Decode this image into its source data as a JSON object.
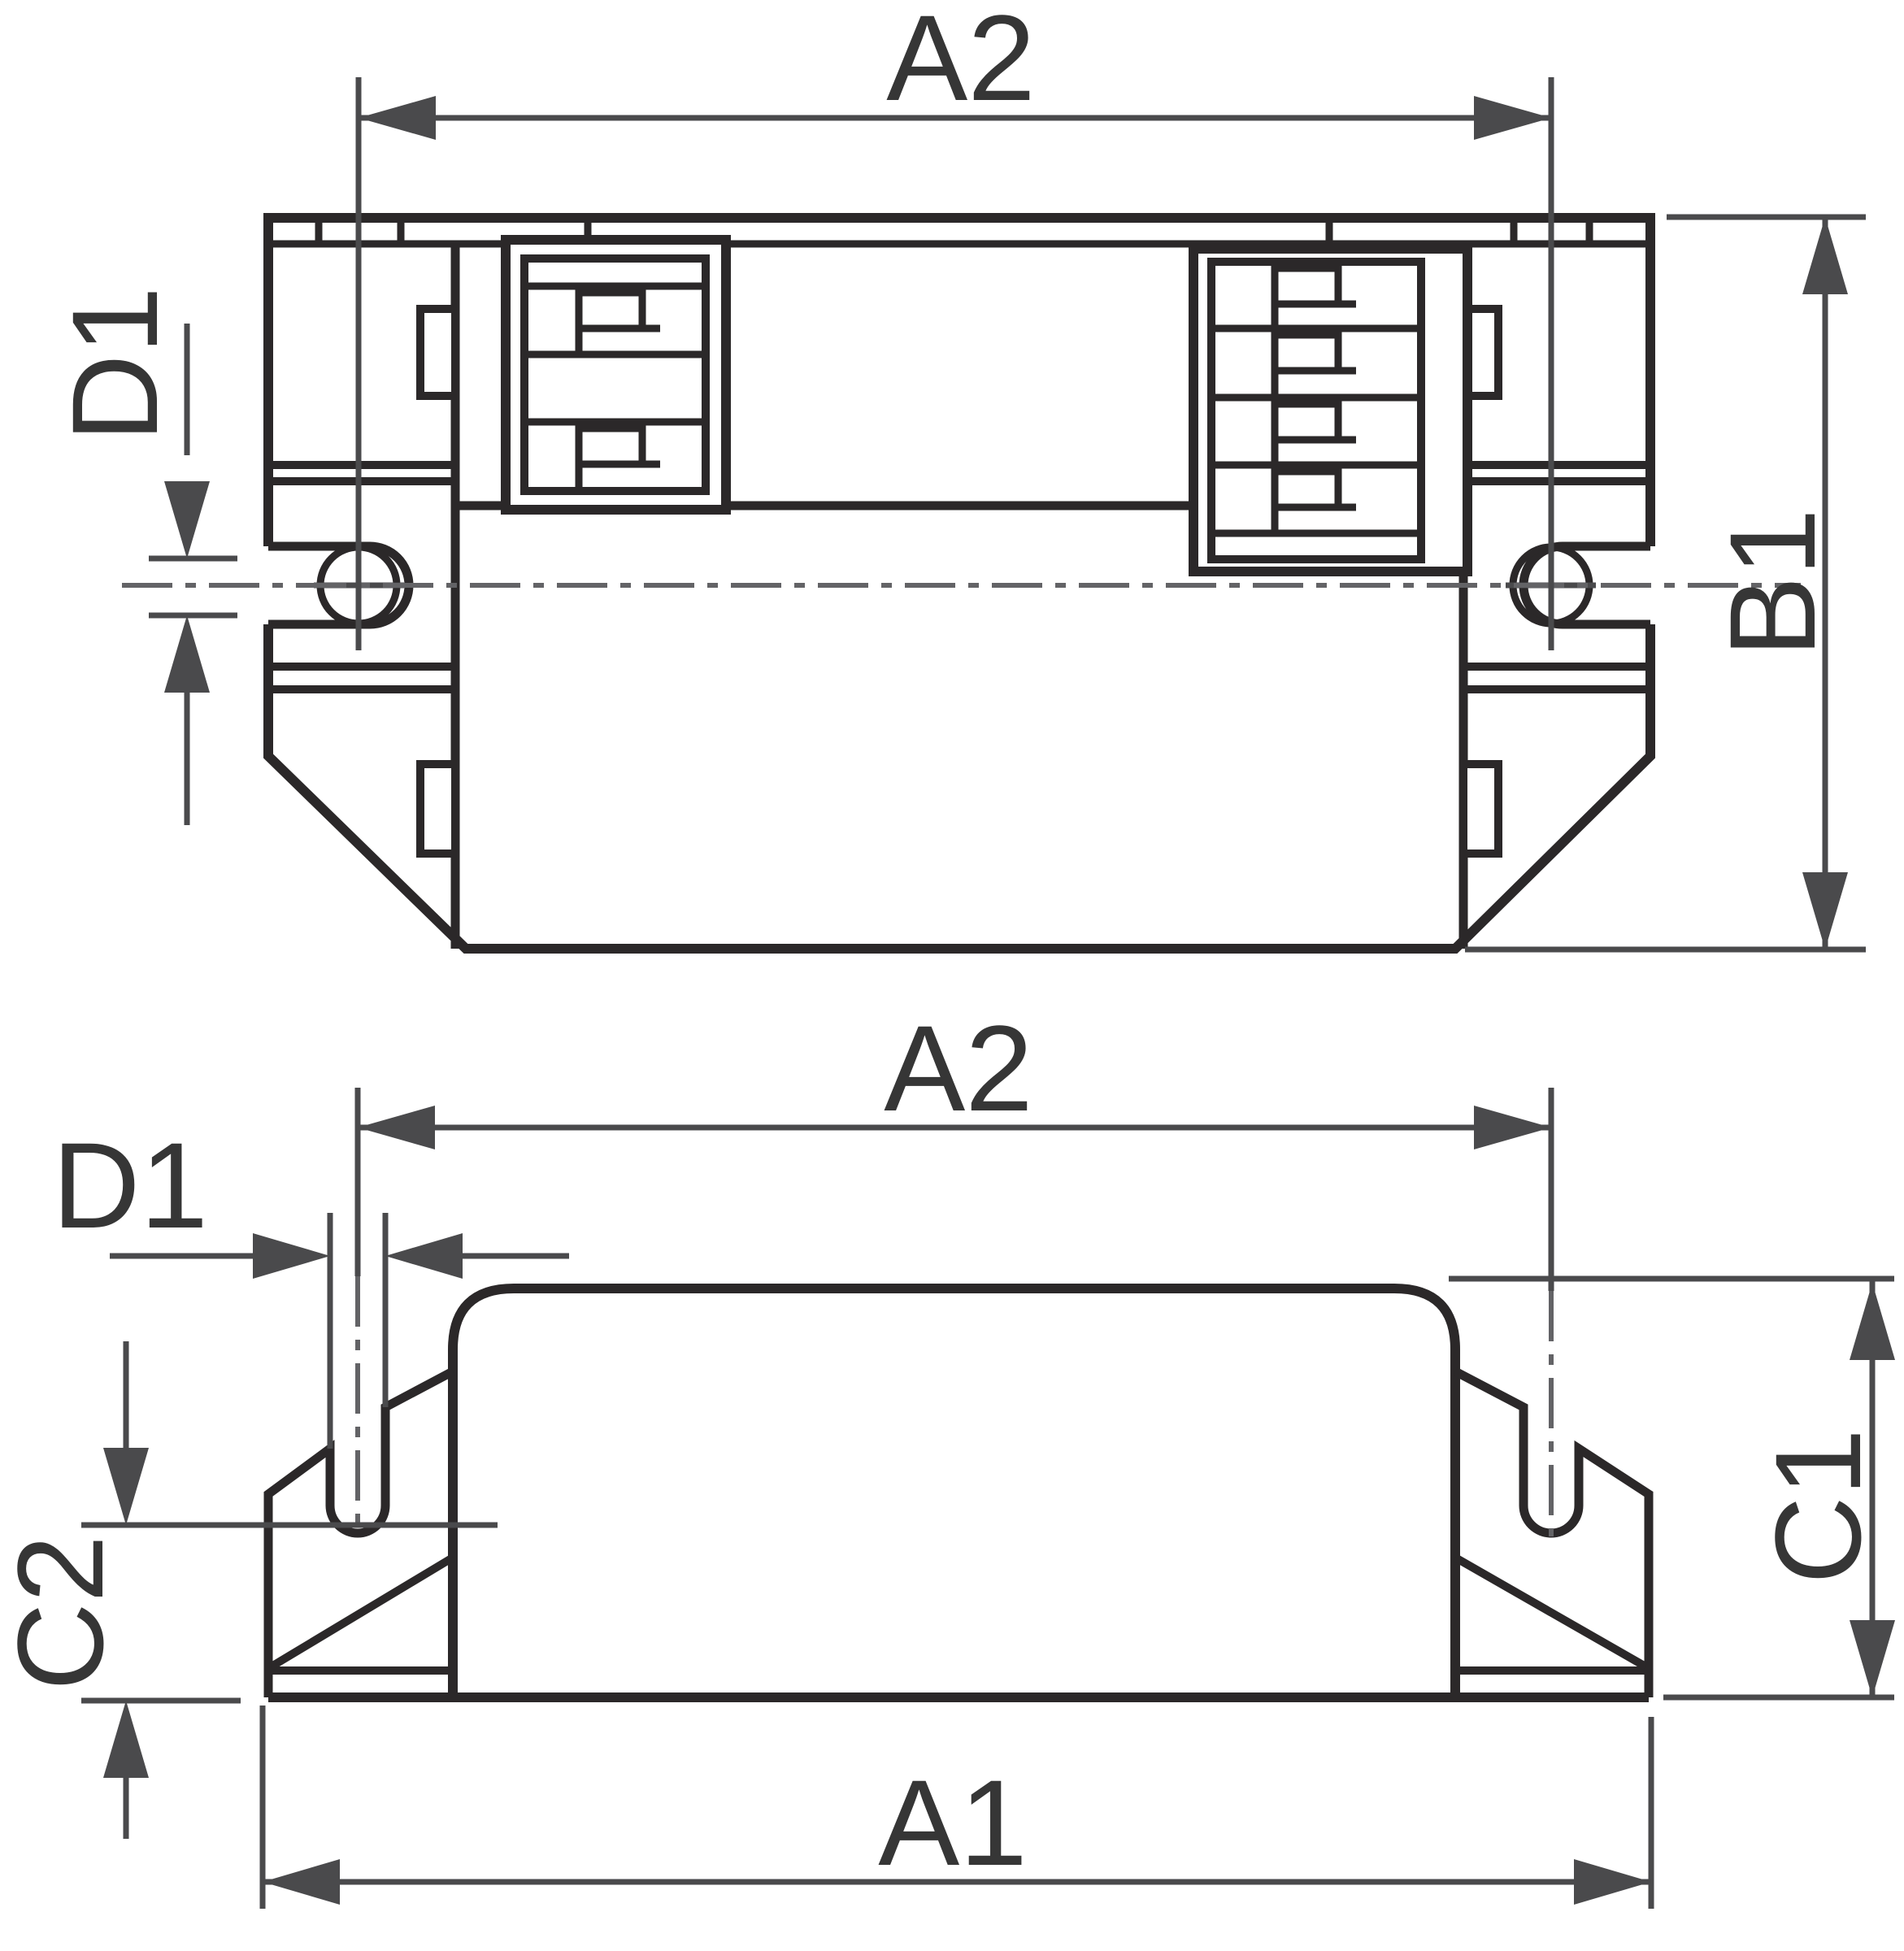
{
  "page": {
    "type": "technical-dimension-drawing",
    "background": "#ffffff"
  },
  "colors": {
    "body_line": "#2b2829",
    "dim_line": "#4a4a4c",
    "center_line": "#636366",
    "text": "#363636"
  },
  "views": {
    "top_view": {
      "name": "ballast top view",
      "labels": {
        "a2": "A2",
        "d1": "D1",
        "b1": "B1"
      }
    },
    "side_view": {
      "name": "ballast side view",
      "labels": {
        "a2": "A2",
        "d1": "D1",
        "c2": "C2",
        "c1": "C1",
        "a1": "A1"
      }
    }
  }
}
